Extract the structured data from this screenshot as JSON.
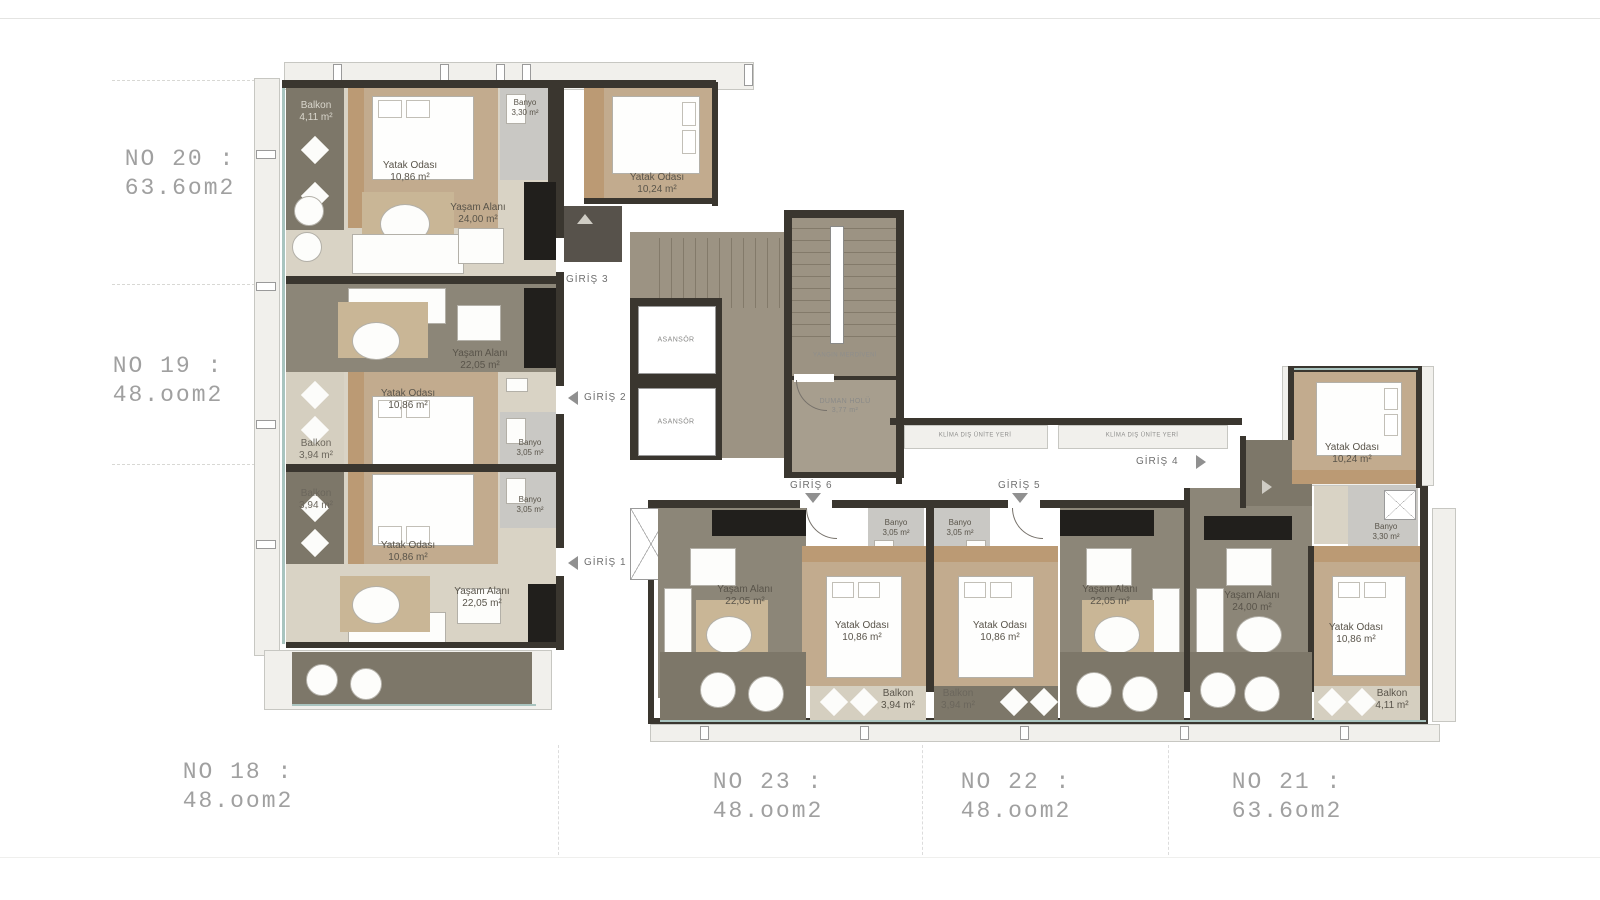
{
  "units": {
    "no20": {
      "name": "NO 20 :",
      "area": "63.6om2"
    },
    "no19": {
      "name": "NO 19 :",
      "area": "48.oom2"
    },
    "no18": {
      "name": "NO 18 :",
      "area": "48.oom2"
    },
    "no23": {
      "name": "NO 23 :",
      "area": "48.oom2"
    },
    "no22": {
      "name": "NO 22 :",
      "area": "48.oom2"
    },
    "no21": {
      "name": "NO 21 :",
      "area": "63.6om2"
    }
  },
  "rooms": [
    {
      "name": "Balkon",
      "area": "4,11 m²"
    },
    {
      "name": "Yatak Odası",
      "area": "10,86 m²"
    },
    {
      "name": "Banyo",
      "area": "3,30 m²"
    },
    {
      "name": "Yatak Odası",
      "area": "10,24 m²"
    },
    {
      "name": "Yaşam Alanı",
      "area": "24,00 m²"
    },
    {
      "name": "Yaşam Alanı",
      "area": "22,05 m²"
    },
    {
      "name": "Yatak Odası",
      "area": "10,86 m²"
    },
    {
      "name": "Balkon",
      "area": "3,94 m²"
    },
    {
      "name": "Banyo",
      "area": "3,05 m²"
    },
    {
      "name": "Balkon",
      "area": "3,94 m²"
    },
    {
      "name": "Yatak Odası",
      "area": "10,86 m²"
    },
    {
      "name": "Banyo",
      "area": "3,05 m²"
    },
    {
      "name": "Yaşam Alanı",
      "area": "22,05 m²"
    },
    {
      "name": "ASANSÖR",
      "area": ""
    },
    {
      "name": "ASANSÖR",
      "area": ""
    },
    {
      "name": "YANGIN MERDİVENİ",
      "area": ""
    },
    {
      "name": "DUMAN HOLÜ",
      "area": "3,77 m²"
    },
    {
      "name": "KLİMA DIŞ ÜNİTE YERİ",
      "area": ""
    },
    {
      "name": "KLİMA DIŞ ÜNİTE YERİ",
      "area": ""
    },
    {
      "name": "Yaşam Alanı",
      "area": "22,05 m²"
    },
    {
      "name": "Banyo",
      "area": "3,05 m²"
    },
    {
      "name": "Yatak Odası",
      "area": "10,86 m²"
    },
    {
      "name": "Balkon",
      "area": "3,94 m²"
    },
    {
      "name": "Banyo",
      "area": "3,05 m²"
    },
    {
      "name": "Yatak Odası",
      "area": "10,86 m²"
    },
    {
      "name": "Balkon",
      "area": "3,94 m²"
    },
    {
      "name": "Yaşam Alanı",
      "area": "22,05 m²"
    },
    {
      "name": "Yaşam Alanı",
      "area": "24,00 m²"
    },
    {
      "name": "Yatak Odası",
      "area": "10,86 m²"
    },
    {
      "name": "Banyo",
      "area": "3,30 m²"
    },
    {
      "name": "Balkon",
      "area": "4,11 m²"
    },
    {
      "name": "Yatak Odası",
      "area": "10,24 m²"
    }
  ],
  "entrances": [
    {
      "label": "GİRİŞ 1",
      "direction": "left"
    },
    {
      "label": "GİRİŞ 2",
      "direction": "left"
    },
    {
      "label": "GİRİŞ 3",
      "direction": "up"
    },
    {
      "label": "GİRİŞ 4",
      "direction": "right"
    },
    {
      "label": "GİRİŞ 5",
      "direction": "down"
    },
    {
      "label": "GİRİŞ 6",
      "direction": "down"
    }
  ],
  "colors": {
    "wall": "#3a362f",
    "wood_floor": "#c2ab8e",
    "wardrobe_band": "#bb9a74",
    "living_olive": "#8c8678",
    "balcony_dark": "#7d7769",
    "living_beige": "#d9d3c5",
    "balcony_light": "#d5cfc0",
    "bathroom": "#c9c8c4",
    "stair": "#9c9383",
    "kitchen": "#211f1c",
    "glass": "#a9c4bf",
    "unit_label_text": "#a0a0a0",
    "room_label_text": "#59544a"
  }
}
